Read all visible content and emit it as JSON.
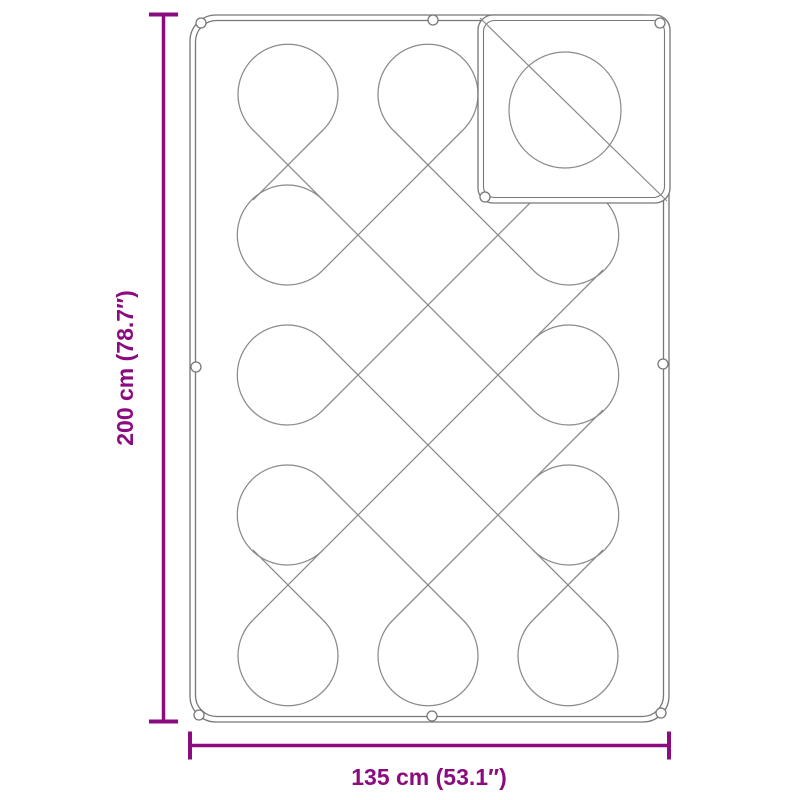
{
  "diagram": {
    "height_label": "200 cm (78.7″)",
    "width_label": "135 cm (53.1″)",
    "accent_color": "#8B0C7E",
    "line_color": "#777777",
    "pattern_line_color": "#8a8a8a",
    "background": "#ffffff"
  }
}
